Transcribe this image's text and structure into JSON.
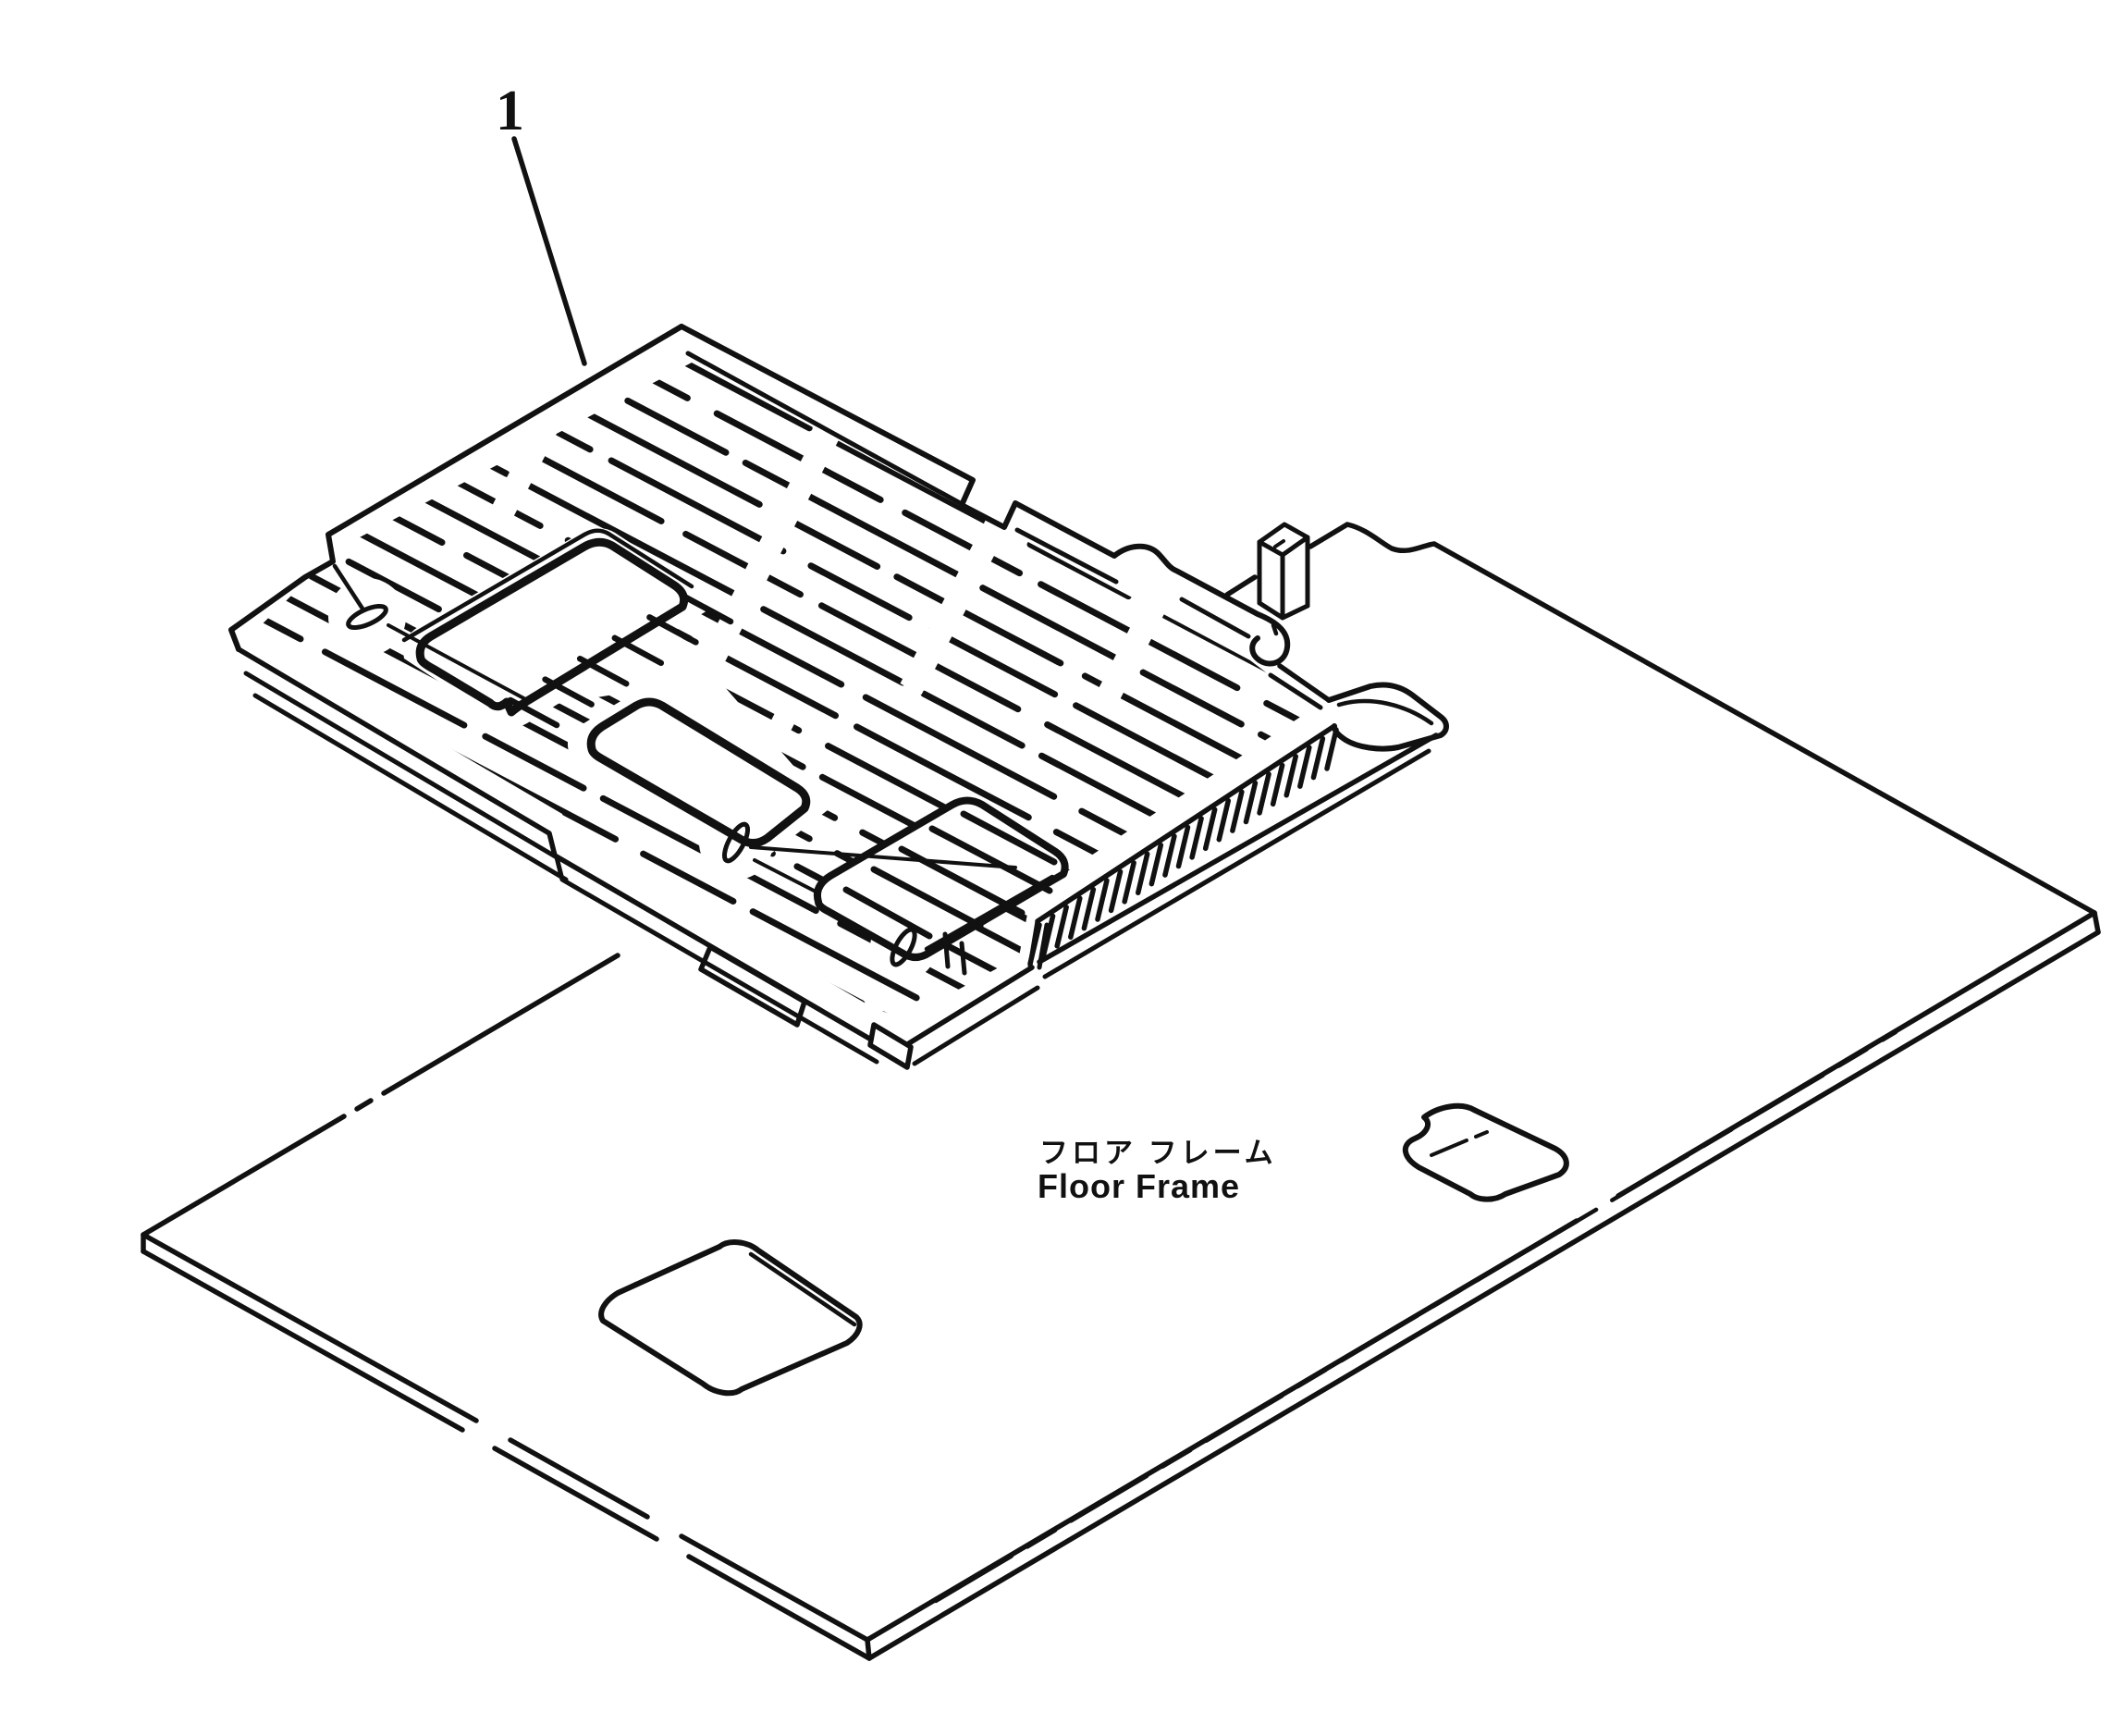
{
  "diagram": {
    "type": "exploded-parts-line-drawing",
    "part_label": "1",
    "caption_jp": "フロア フレーム",
    "caption_en": "Floor Frame",
    "parts": [
      {
        "id": "1",
        "name_en": "Floor Mat (ribbed)",
        "points_to": "hatched mat panel"
      },
      {
        "id": "floor-frame",
        "name_en": "Floor Frame",
        "name_jp": "フロア フレーム"
      }
    ],
    "colors": {
      "ink": "#111111",
      "paper": "#ffffff"
    }
  }
}
